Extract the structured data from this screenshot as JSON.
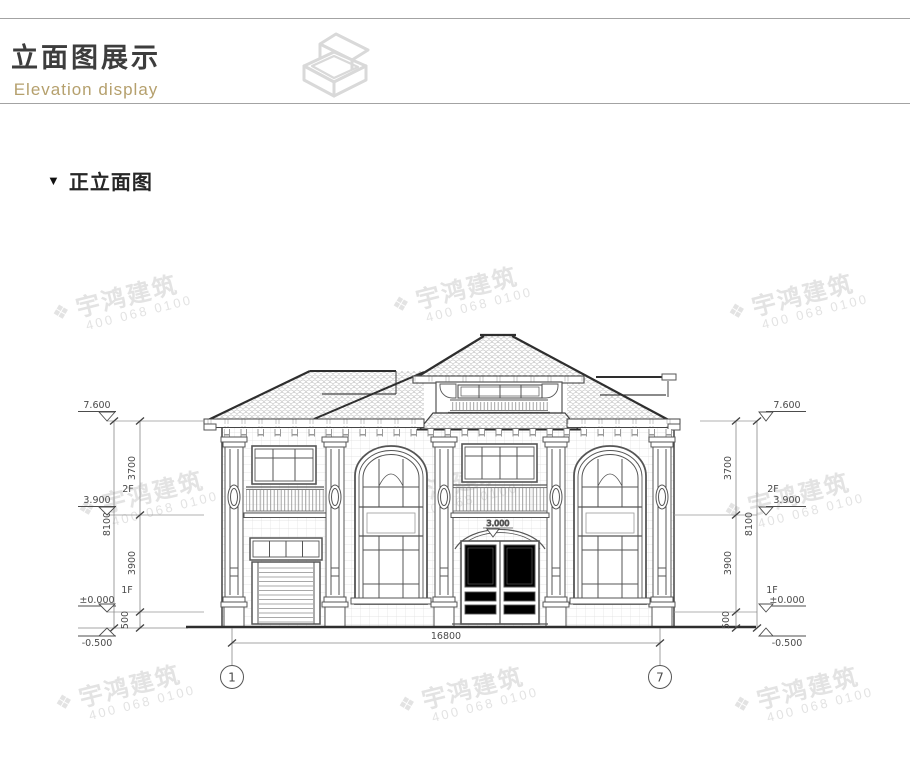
{
  "header": {
    "title": "立面图展示",
    "subtitle": "Elevation display"
  },
  "section": {
    "marker": "▼",
    "title": "正立面图"
  },
  "watermark": {
    "logo": "❖",
    "brand": "宇鸿建筑",
    "phone": "400 068 0100"
  },
  "drawing": {
    "levels": {
      "roof": "7.600",
      "floor2": "3.900",
      "floor1": "±0.000",
      "base": "-0.500",
      "door_top": "3.000"
    },
    "floors": {
      "f2": "2F",
      "f1": "1F"
    },
    "dims": {
      "v_upper": "3700",
      "v_lower": "3900",
      "v_total": "8100",
      "v_plinth": "500",
      "h_total": "16800"
    },
    "axes": {
      "a1": "1",
      "a7": "7"
    }
  }
}
